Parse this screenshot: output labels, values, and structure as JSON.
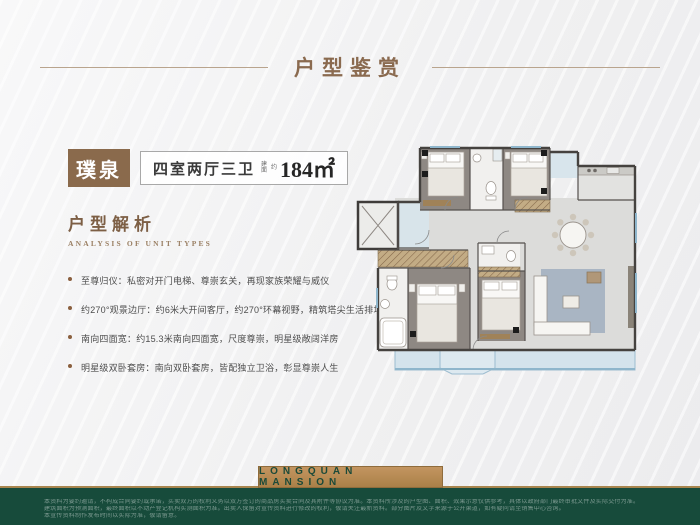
{
  "header": {
    "title": "户型鉴赏"
  },
  "unit": {
    "name": "璞泉",
    "layout": "四室两厅三卫",
    "area_prefix_small": "建面",
    "area_approx_small": "约",
    "area_value": "184㎡"
  },
  "analysis": {
    "title": "户型解析",
    "subtitle": "ANALYSIS OF UNIT TYPES",
    "bullets": [
      "至尊归仪：私密对开门电梯、尊崇玄关，再现家族荣耀与威仪",
      "约270°观景边厅：约6米大开间客厅，约270°环幕视野，精筑塔尖生活排场",
      "南向四面宽：约15.3米南向四面宽，尺度尊崇，明星级敞阔洋房",
      "明星级双卧套房：南向双卧套房，皆配独立卫浴，彰显尊崇人生"
    ]
  },
  "footer": {
    "brand": "LONGQUAN MANSION",
    "disclaimer_lines": [
      "本资料为要约邀请，不构成合同要约或承诺，买卖双方的权利义务以双方签订的商品房买卖合同及其附件等协议为准。本资料所涉及的户型图、面积、效果示意仅供参考，具体以政府部门最终审批文件及实际交付为准。",
      "建筑面积为预测面积，最终面积以不动产登记机构实测面积为准。出卖人保留对宣传资料进行修改的权利，敬请关注最新资料。部分图片及文字来源于公开渠道，如有疑问请至销售中心咨询。",
      "本宣传资料制作发布时间以实际为准，敬请留意。"
    ]
  },
  "colors": {
    "accent_brown": "#8a6a4c",
    "footer_green": "#174b3b",
    "brand_gold": "#b78a52",
    "window_blue": "#8fb6cc"
  }
}
